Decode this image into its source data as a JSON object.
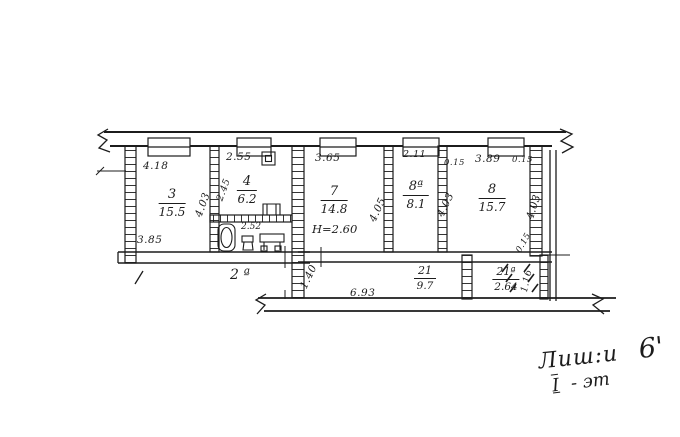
{
  "meta": {
    "type": "apartment-floor-plan-scan",
    "ink_color": "#1c1c1c",
    "paper_color": "#ffffff"
  },
  "rooms": {
    "r3": {
      "number": "3",
      "area": "15.5"
    },
    "r4": {
      "number": "4",
      "area": "6.2"
    },
    "r7": {
      "number": "7",
      "area": "14.8",
      "height": "H=2.60"
    },
    "r8a": {
      "number": "8ª",
      "area": "8.1"
    },
    "r8": {
      "number": "8",
      "area": "15.7"
    },
    "r21": {
      "number": "21",
      "area": "9.7"
    },
    "r21a": {
      "number": "21ª",
      "area": "2.64"
    },
    "bath": {
      "area": "2.52"
    },
    "annex": {
      "label": "2 ª"
    }
  },
  "dimensions": {
    "top_r3": "4.18",
    "top_r4": "2.55",
    "top_r7": "3.65",
    "top_r8a": "2.11",
    "top_r8_left": "0.15",
    "top_r8": "3.89",
    "top_r8_right": "0.15",
    "bottom_r3": "3.85",
    "right_r3": "4.03",
    "left_r4": "2.45",
    "right_r7": "4.05",
    "right_r8a": "4.03",
    "right_r8": "4.03",
    "corridor_height": "1.40",
    "corridor_length": "6.93",
    "right_mid": "0.15",
    "right_low": "1.16"
  },
  "note": {
    "word": "Лиш:и",
    "number": "6'",
    "floor_numeral": "I",
    "floor_rest": "- эт"
  }
}
